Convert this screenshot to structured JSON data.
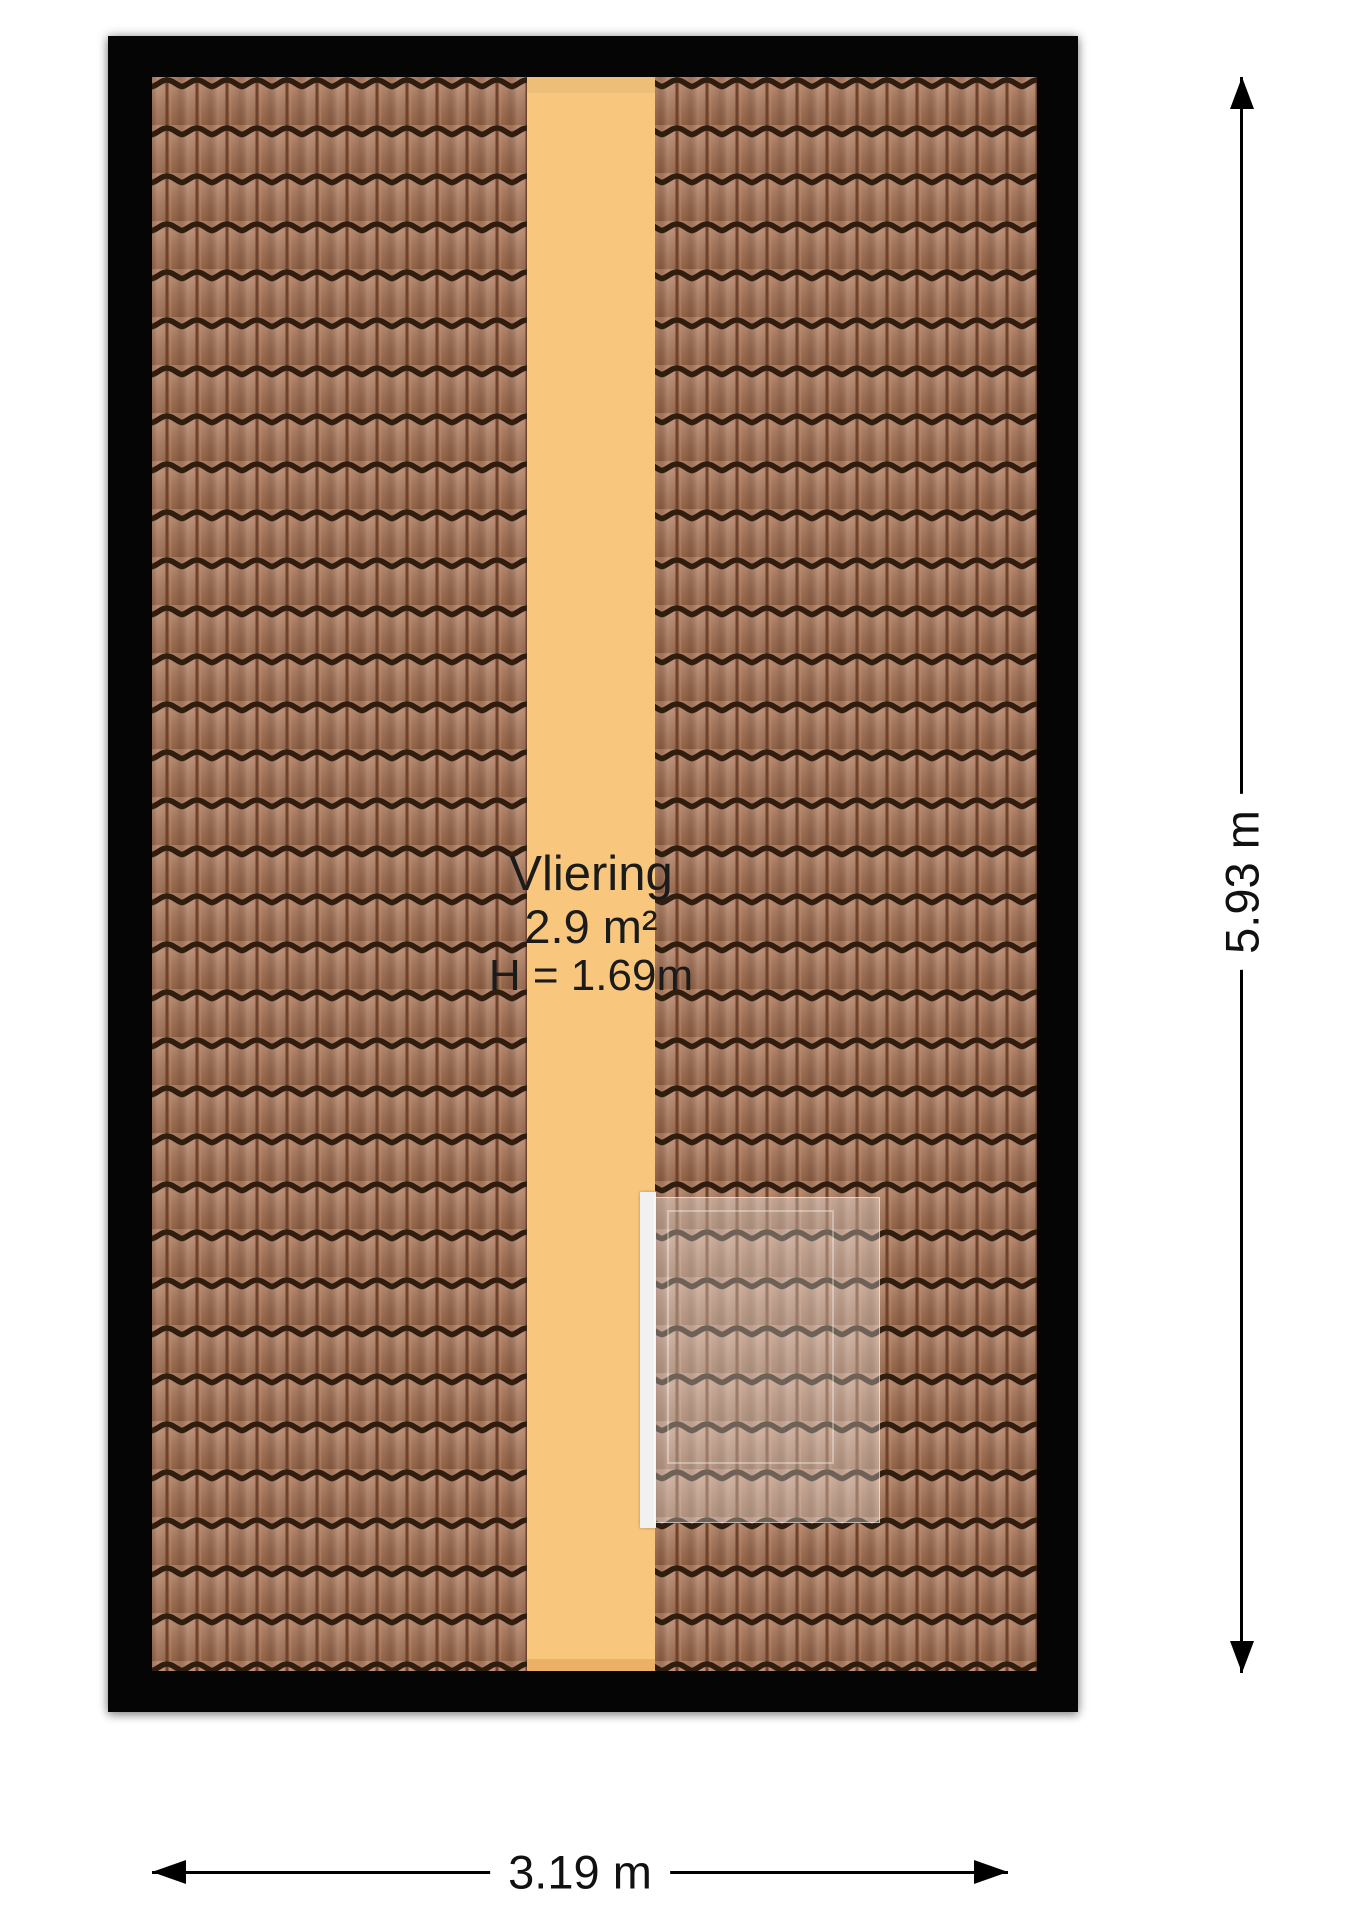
{
  "room": {
    "name": "Vliering",
    "area": "2.9 m²",
    "height": "H = 1.69m"
  },
  "dimensions": {
    "vertical_label": "5.93 m",
    "horizontal_label": "3.19 m"
  },
  "colors": {
    "background": "#ffffff",
    "frame": "#050505",
    "tile_base": "#a56e4e",
    "tile_groove": "#6d432d",
    "tile_groove_highlight": "#c08a66",
    "tile_wave": "#301d10",
    "floor_strip": "#f8c77d",
    "floor_strip_shade": "#eab167",
    "skylight_frame": "#f1f1f1",
    "label_text": "#1b1b1b",
    "dimension_color": "#000000"
  }
}
